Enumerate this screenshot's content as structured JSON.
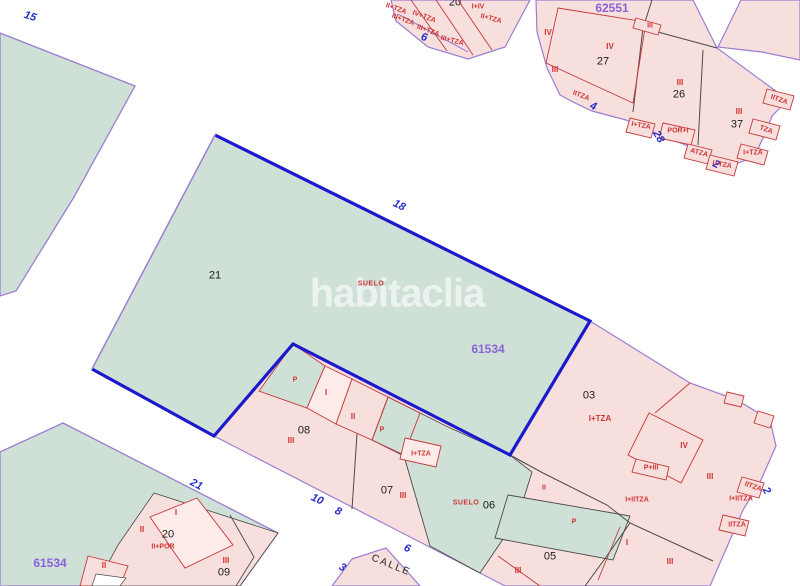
{
  "watermark": {
    "text": "habitaclia"
  },
  "colors": {
    "parcel_green": "#cfe1d7",
    "parcel_pink": "#f7dfdd",
    "parcel_pink_light": "#fcebe9",
    "boundary_blue": "#1a1acc",
    "boundary_purple": "#9b7ed2",
    "line_black": "#4a4a4a",
    "line_red": "#c63838",
    "text_red": "#d03434",
    "text_blue": "#2430c8",
    "text_purple": "#8a62d8",
    "text_black": "#1b1b1b",
    "street_white": "#ffffff"
  },
  "map": {
    "labels": [
      {
        "name": "block-id",
        "text": "62551",
        "x": 612,
        "y": 8,
        "cls": "purple"
      },
      {
        "name": "block-id",
        "text": "61534",
        "x": 488,
        "y": 349,
        "cls": "purple"
      },
      {
        "name": "block-id",
        "text": "61534",
        "x": 50,
        "y": 563,
        "cls": "purple"
      },
      {
        "name": "street-number",
        "text": "15",
        "x": 30,
        "y": 17,
        "cls": "blue",
        "rot": 18
      },
      {
        "name": "street-number",
        "text": "6",
        "x": 424,
        "y": 38,
        "cls": "blue",
        "rot": 15
      },
      {
        "name": "street-number",
        "text": "4",
        "x": 593,
        "y": 107,
        "cls": "blue",
        "rot": 22
      },
      {
        "name": "street-number",
        "text": "28",
        "x": 658,
        "y": 137,
        "cls": "blue",
        "rot": 60
      },
      {
        "name": "street-number",
        "text": "2",
        "x": 716,
        "y": 165,
        "cls": "blue",
        "rot": 25
      },
      {
        "name": "street-number",
        "text": "18",
        "x": 399,
        "y": 206,
        "cls": "blue",
        "rot": 26
      },
      {
        "name": "street-number",
        "text": "10",
        "x": 317,
        "y": 500,
        "cls": "blue",
        "rot": 25
      },
      {
        "name": "street-number",
        "text": "8",
        "x": 338,
        "y": 512,
        "cls": "blue",
        "rot": 25
      },
      {
        "name": "street-number",
        "text": "6",
        "x": 407,
        "y": 549,
        "cls": "blue",
        "rot": 25
      },
      {
        "name": "street-number",
        "text": "3",
        "x": 342,
        "y": 568,
        "cls": "blue",
        "rot": 30
      },
      {
        "name": "street-number",
        "text": "2",
        "x": 766,
        "y": 491,
        "cls": "blue",
        "rot": 60
      },
      {
        "name": "street-number",
        "text": "21",
        "x": 196,
        "y": 485,
        "cls": "blue",
        "rot": 28
      },
      {
        "name": "parcel-number",
        "text": "20",
        "x": 455,
        "y": 3,
        "cls": "black"
      },
      {
        "name": "parcel-number",
        "text": "27",
        "x": 603,
        "y": 62,
        "cls": "black"
      },
      {
        "name": "parcel-number",
        "text": "26",
        "x": 679,
        "y": 95,
        "cls": "black"
      },
      {
        "name": "parcel-number",
        "text": "37",
        "x": 737,
        "y": 125,
        "cls": "black"
      },
      {
        "name": "parcel-number",
        "text": "21",
        "x": 215,
        "y": 276,
        "cls": "black"
      },
      {
        "name": "parcel-number",
        "text": "03",
        "x": 589,
        "y": 396,
        "cls": "black"
      },
      {
        "name": "parcel-number",
        "text": "08",
        "x": 304,
        "y": 431,
        "cls": "black"
      },
      {
        "name": "parcel-number",
        "text": "07",
        "x": 387,
        "y": 491,
        "cls": "black"
      },
      {
        "name": "parcel-number",
        "text": "06",
        "x": 489,
        "y": 506,
        "cls": "black"
      },
      {
        "name": "parcel-number",
        "text": "05",
        "x": 550,
        "y": 557,
        "cls": "black"
      },
      {
        "name": "parcel-number",
        "text": "20",
        "x": 168,
        "y": 535,
        "cls": "black"
      },
      {
        "name": "parcel-number",
        "text": "09",
        "x": 224,
        "y": 573,
        "cls": "black"
      },
      {
        "name": "street-name",
        "text": "CALLE",
        "x": 391,
        "y": 566,
        "cls": "street",
        "rot": 22
      },
      {
        "name": "suelo-label",
        "text": "SUELO",
        "x": 371,
        "y": 284,
        "cls": "suelo"
      },
      {
        "name": "suelo-label",
        "text": "SUELO",
        "x": 466,
        "y": 503,
        "cls": "suelo"
      },
      {
        "name": "construction-label",
        "text": "IV",
        "x": 610,
        "y": 47,
        "cls": "red"
      },
      {
        "name": "construction-label",
        "text": "III",
        "x": 555,
        "y": 70,
        "cls": "red"
      },
      {
        "name": "construction-label",
        "text": "III",
        "x": 680,
        "y": 83,
        "cls": "red"
      },
      {
        "name": "construction-label",
        "text": "III",
        "x": 739,
        "y": 112,
        "cls": "red"
      },
      {
        "name": "construction-label",
        "text": "IITZA",
        "x": 581,
        "y": 96,
        "cls": "red-sm",
        "rot": 22
      },
      {
        "name": "construction-label",
        "text": "I+TZA",
        "x": 641,
        "y": 126,
        "cls": "red-sm",
        "rot": 10
      },
      {
        "name": "construction-label",
        "text": "POR+I",
        "x": 678,
        "y": 131,
        "cls": "red-sm"
      },
      {
        "name": "construction-label",
        "text": "ATZA",
        "x": 699,
        "y": 153,
        "cls": "red-sm",
        "rot": 15
      },
      {
        "name": "construction-label",
        "text": "I+TZA",
        "x": 722,
        "y": 165,
        "cls": "red-sm",
        "rot": 10
      },
      {
        "name": "construction-label",
        "text": "I+TZA",
        "x": 753,
        "y": 153,
        "cls": "red-sm"
      },
      {
        "name": "construction-label",
        "text": "TZA",
        "x": 766,
        "y": 130,
        "cls": "red-sm",
        "rot": 20
      },
      {
        "name": "construction-label",
        "text": "IITZA",
        "x": 779,
        "y": 100,
        "cls": "red-sm",
        "rot": 20
      },
      {
        "name": "construction-label",
        "text": "III",
        "x": 650,
        "y": 26,
        "cls": "red-sm"
      },
      {
        "name": "construction-label",
        "text": "IV",
        "x": 548,
        "y": 33,
        "cls": "red"
      },
      {
        "name": "construction-label",
        "text": "II+TZA",
        "x": 396,
        "y": 9,
        "cls": "red-sm",
        "rot": 20
      },
      {
        "name": "construction-label",
        "text": "III+TZA",
        "x": 403,
        "y": 20,
        "cls": "red-sm",
        "rot": 20
      },
      {
        "name": "construction-label",
        "text": "IV+TZA",
        "x": 424,
        "y": 17,
        "cls": "red-sm",
        "rot": 20
      },
      {
        "name": "construction-label",
        "text": "III+TZA",
        "x": 428,
        "y": 31,
        "cls": "red-sm",
        "rot": 20
      },
      {
        "name": "construction-label",
        "text": "III+TZA",
        "x": 452,
        "y": 41,
        "cls": "red-sm",
        "rot": 15
      },
      {
        "name": "construction-label",
        "text": "I+IV",
        "x": 478,
        "y": 7,
        "cls": "red-sm"
      },
      {
        "name": "construction-label",
        "text": "II+TZA",
        "x": 491,
        "y": 19,
        "cls": "red-sm",
        "rot": 15
      },
      {
        "name": "construction-label",
        "text": "I+TZA",
        "x": 600,
        "y": 419,
        "cls": "red"
      },
      {
        "name": "construction-label",
        "text": "IV",
        "x": 684,
        "y": 446,
        "cls": "red"
      },
      {
        "name": "construction-label",
        "text": "III",
        "x": 710,
        "y": 477,
        "cls": "red"
      },
      {
        "name": "construction-label",
        "text": "P+III",
        "x": 651,
        "y": 468,
        "cls": "red-sm"
      },
      {
        "name": "construction-label",
        "text": "I+IITZA",
        "x": 637,
        "y": 500,
        "cls": "red-sm"
      },
      {
        "name": "construction-label",
        "text": "IITZA",
        "x": 753,
        "y": 487,
        "cls": "red-sm",
        "rot": 20
      },
      {
        "name": "construction-label",
        "text": "I+IITZA",
        "x": 741,
        "y": 499,
        "cls": "red-sm"
      },
      {
        "name": "construction-label",
        "text": "IITZA",
        "x": 737,
        "y": 525,
        "cls": "red-sm"
      },
      {
        "name": "construction-label",
        "text": "I",
        "x": 627,
        "y": 543,
        "cls": "red"
      },
      {
        "name": "construction-label",
        "text": "III",
        "x": 670,
        "y": 562,
        "cls": "red"
      },
      {
        "name": "construction-label",
        "text": "P",
        "x": 295,
        "y": 380,
        "cls": "red-sm"
      },
      {
        "name": "construction-label",
        "text": "I",
        "x": 326,
        "y": 393,
        "cls": "red"
      },
      {
        "name": "construction-label",
        "text": "II",
        "x": 353,
        "y": 417,
        "cls": "red"
      },
      {
        "name": "construction-label",
        "text": "P",
        "x": 382,
        "y": 430,
        "cls": "red-sm"
      },
      {
        "name": "construction-label",
        "text": "III",
        "x": 291,
        "y": 441,
        "cls": "red"
      },
      {
        "name": "construction-label",
        "text": "I+TZA",
        "x": 421,
        "y": 454,
        "cls": "red-sm"
      },
      {
        "name": "construction-label",
        "text": "III",
        "x": 403,
        "y": 496,
        "cls": "red"
      },
      {
        "name": "construction-label",
        "text": "II",
        "x": 544,
        "y": 488,
        "cls": "red-sm"
      },
      {
        "name": "construction-label",
        "text": "P",
        "x": 574,
        "y": 522,
        "cls": "red-sm"
      },
      {
        "name": "construction-label",
        "text": "III",
        "x": 518,
        "y": 571,
        "cls": "red"
      },
      {
        "name": "construction-label",
        "text": "I",
        "x": 176,
        "y": 513,
        "cls": "red"
      },
      {
        "name": "construction-label",
        "text": "II",
        "x": 142,
        "y": 530,
        "cls": "red"
      },
      {
        "name": "construction-label",
        "text": "II+POR",
        "x": 163,
        "y": 547,
        "cls": "red-sm"
      },
      {
        "name": "construction-label",
        "text": "II",
        "x": 104,
        "y": 566,
        "cls": "red"
      },
      {
        "name": "construction-label",
        "text": "III",
        "x": 226,
        "y": 561,
        "cls": "red"
      }
    ]
  }
}
